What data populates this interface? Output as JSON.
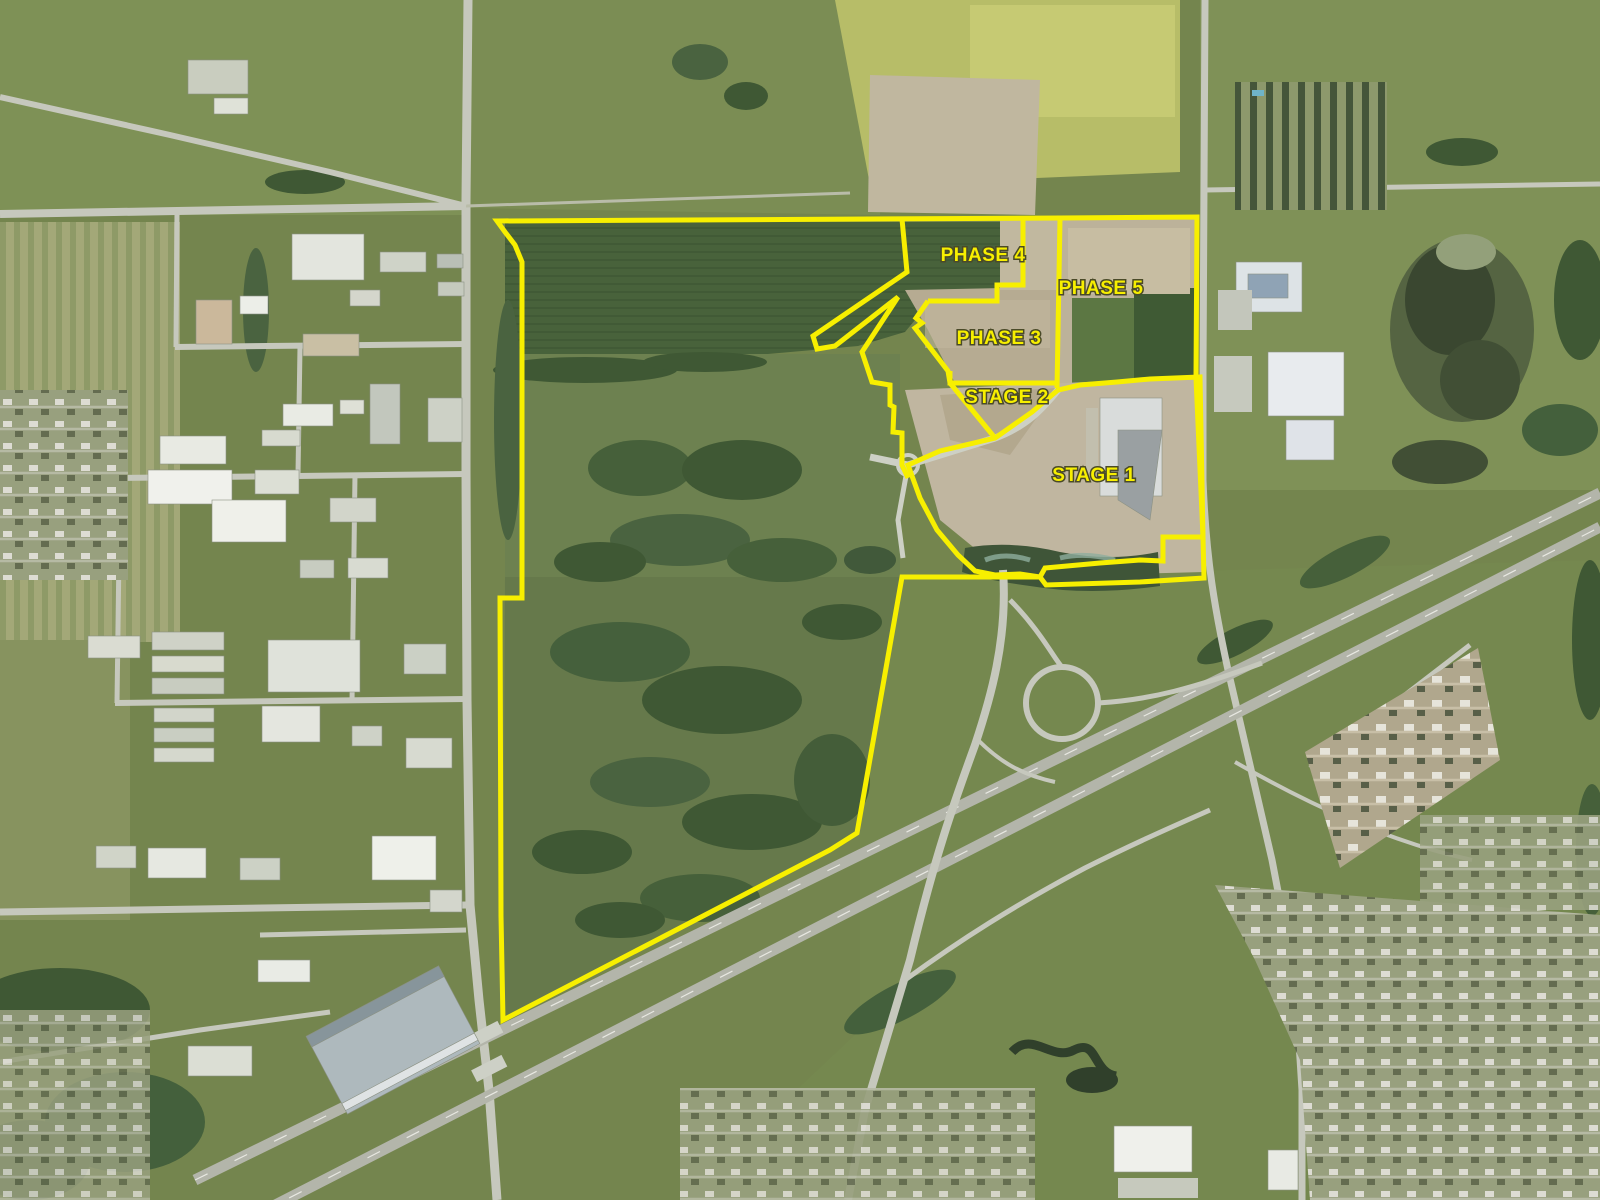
{
  "map": {
    "description": "Aerial development phasing map",
    "base_color": "#74854e",
    "overlay": {
      "stroke_color": "#f7ef00",
      "stroke_width": 5,
      "label_color": "#f7ef00",
      "label_outline_color": "#4a4a28",
      "label_font_size": 19,
      "labels": [
        {
          "id": "label-phase-4",
          "text": "PHASE 4",
          "x": 983,
          "y": 261
        },
        {
          "id": "label-phase-5",
          "text": "PHASE 5",
          "x": 1101,
          "y": 294
        },
        {
          "id": "label-phase-3",
          "text": "PHASE 3",
          "x": 999,
          "y": 344
        },
        {
          "id": "label-stage-2",
          "text": "STAGE 2",
          "x": 1007,
          "y": 403
        },
        {
          "id": "label-stage-1",
          "text": "STAGE 1",
          "x": 1094,
          "y": 481
        }
      ],
      "outlines": [
        {
          "id": "property-boundary",
          "closed": true,
          "points": [
            [
              497,
              221
            ],
            [
              1060,
              218
            ],
            [
              1197,
              217
            ],
            [
              1196,
              378
            ],
            [
              1203,
              537
            ],
            [
              1204,
              578
            ],
            [
              1140,
              582
            ],
            [
              1046,
              585
            ],
            [
              1040,
              577
            ],
            [
              902,
              577
            ],
            [
              857,
              833
            ],
            [
              830,
              850
            ],
            [
              503,
              1020
            ],
            [
              501,
              916
            ],
            [
              500,
              598
            ],
            [
              522,
              598
            ],
            [
              522,
              262
            ],
            [
              515,
              245
            ],
            [
              505,
              232
            ]
          ]
        },
        {
          "id": "stage-1-boundary",
          "closed": true,
          "points": [
            [
              908,
              465
            ],
            [
              940,
              451
            ],
            [
              995,
              438
            ],
            [
              1032,
              412
            ],
            [
              1058,
              390
            ],
            [
              1080,
              385
            ],
            [
              1117,
              382
            ],
            [
              1150,
              379
            ],
            [
              1200,
              377
            ],
            [
              1203,
              537
            ],
            [
              1163,
              537
            ],
            [
              1163,
              561
            ],
            [
              1140,
              560
            ],
            [
              1100,
              563
            ],
            [
              1045,
              568
            ],
            [
              1040,
              577
            ],
            [
              1020,
              574
            ],
            [
              995,
              575
            ],
            [
              975,
              571
            ],
            [
              958,
              555
            ],
            [
              937,
              530
            ],
            [
              920,
              498
            ]
          ]
        },
        {
          "id": "phase-4-east-boundary",
          "closed": false,
          "points": [
            [
              1023,
              219
            ],
            [
              1023,
              285
            ],
            [
              997,
              285
            ],
            [
              997,
              301
            ],
            [
              928,
              301
            ]
          ]
        },
        {
          "id": "phase-4-west-boundary",
          "closed": false,
          "points": [
            [
              902,
              219
            ],
            [
              907,
              272
            ],
            [
              813,
              336
            ],
            [
              817,
              349
            ],
            [
              835,
              346
            ],
            [
              898,
              297
            ],
            [
              862,
              352
            ],
            [
              872,
              382
            ],
            [
              890,
              385
            ],
            [
              890,
              405
            ],
            [
              894,
              407
            ],
            [
              893,
              432
            ],
            [
              902,
              433
            ],
            [
              902,
              465
            ],
            [
              908,
              478
            ]
          ]
        },
        {
          "id": "phase-3-west-boundary",
          "closed": false,
          "points": [
            [
              928,
              301
            ],
            [
              916,
              318
            ],
            [
              922,
              323
            ],
            [
              915,
              328
            ],
            [
              948,
              371
            ],
            [
              950,
              383
            ]
          ]
        },
        {
          "id": "phase-5-west-boundary",
          "closed": false,
          "points": [
            [
              1060,
              219
            ],
            [
              1057,
              388
            ]
          ]
        },
        {
          "id": "stage-2-north-boundary",
          "closed": false,
          "points": [
            [
              950,
              371
            ],
            [
              950,
              383
            ],
            [
              1058,
              383
            ]
          ]
        },
        {
          "id": "stage-2-west-boundary",
          "closed": false,
          "points": [
            [
              950,
              383
            ],
            [
              995,
              438
            ]
          ]
        }
      ]
    }
  }
}
